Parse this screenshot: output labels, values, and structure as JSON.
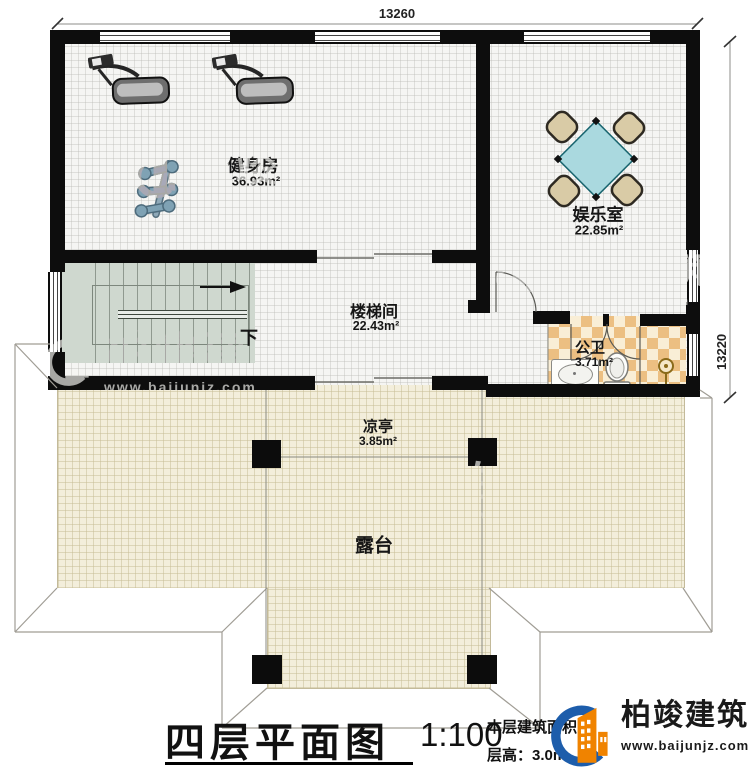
{
  "page": {
    "background": "#ffffff",
    "type": "architectural floor plan"
  },
  "dimensions": {
    "top": "13260",
    "right": "13220"
  },
  "rooms": {
    "gym": {
      "name": "健身房",
      "area": "36.93m²"
    },
    "entertainment": {
      "name": "娱乐室",
      "area": "22.85m²"
    },
    "stairwell": {
      "name": "楼梯间",
      "area": "22.43m²"
    },
    "bathroom": {
      "name": "公卫",
      "area": "3.71m²"
    },
    "pavilion": {
      "name": "凉亭",
      "area": "3.85m²"
    },
    "terrace": {
      "name": "露台"
    }
  },
  "stairs": {
    "direction_label": "下"
  },
  "title_block": {
    "title": "四层平面图",
    "scale": "1:100",
    "floor_area_label": "本层建筑面积：",
    "floor_height_label": "层高：3.0m"
  },
  "brand": {
    "name": "柏竣建筑",
    "website": "www.baijunjz.com",
    "colors": {
      "orange": "#f08300",
      "blue": "#1d5dab"
    }
  },
  "watermark": {
    "name": "柏竣建筑",
    "website": "www.baijunjz.com"
  },
  "icons": {
    "treadmill-icon": "svg-shape",
    "dumbbell-rack-icon": "svg-shape",
    "dining-table-icon": "svg-shape",
    "chair-icon": "svg-shape",
    "sink-icon": "css-shape",
    "toilet-icon": "svg-shape",
    "shower-drain-icon": "svg-shape",
    "stairs-down-arrow-icon": "svg-arrow",
    "brand-logo-icon": "svg-building-mark"
  },
  "palette": {
    "wall": "#0d0d0d",
    "room_floor": "#f5f5f3",
    "terrace_floor": "#f3eedb",
    "stairs_floor": "#cfd8cf",
    "bath_checker_1": "#ecbf82",
    "bath_checker_2": "#f9eed6",
    "table_top": "#aad9df",
    "chair": "#d9cba6"
  }
}
